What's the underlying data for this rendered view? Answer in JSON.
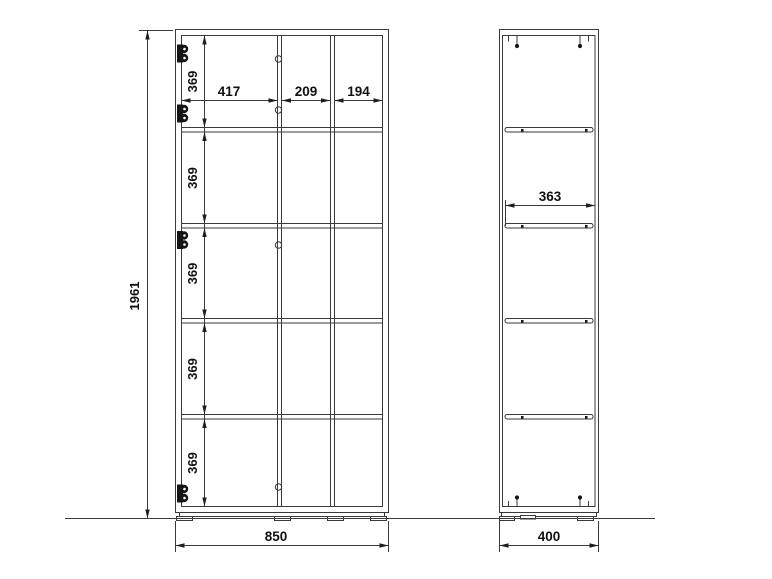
{
  "colors": {
    "background": "#ffffff",
    "line": "#3a3a3a",
    "fitting": "#151515",
    "text": "#111111"
  },
  "icons": {
    "hinge": "hinge-icon",
    "pin_hole": "pin-hole-icon",
    "fitting_pin": "fitting-pin-icon",
    "shelf_pin": "shelf-pin-icon"
  },
  "front_view": {
    "overall_height": "1961",
    "overall_width": "850",
    "column_widths": [
      "417",
      "209",
      "194"
    ],
    "row_heights": [
      "369",
      "369",
      "369",
      "369",
      "369"
    ]
  },
  "side_view": {
    "overall_width": "400",
    "shelf_depth": "363"
  }
}
